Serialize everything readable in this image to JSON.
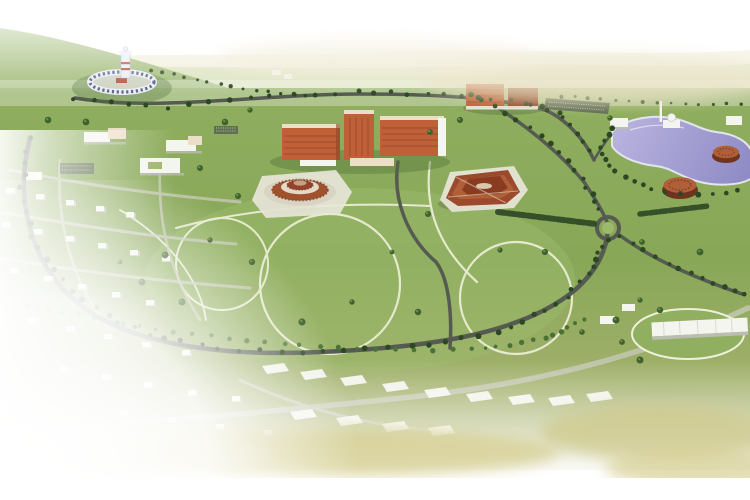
{
  "image": {
    "kind": "3d-aerial-masterplan-render",
    "width": 750,
    "height": 500
  },
  "colors": {
    "sky_white": "#ffffff",
    "haze_tan": "#e9e1c3",
    "haze_green": "#cfdcae",
    "hill_green": "#9cb873",
    "ground_top": "#8fae5f",
    "ground_mid": "#88a757",
    "ground_low": "#a4b16d",
    "ground_bottom": "#b8bd84",
    "ground_shadow": "#4f6f3a",
    "lawn_light": "#9cb96c",
    "road_dark": "#565b52",
    "road_light": "#c6c9b6",
    "path_cream": "#eef1da",
    "tree_dark": "#2c4723",
    "tree_mid": "#3f6130",
    "tree_light": "#67903f",
    "palm": "#4a7238",
    "lake_light": "#bab5e0",
    "lake_deep": "#8d89c4",
    "shore": "#e2e4ee",
    "white_bldg": "#f5f5f0",
    "bldg_shadow": "#b9bdb2",
    "red_bldg": "#c06038",
    "red_bldg_dark": "#8e4526",
    "roof_cream": "#ecdfc8",
    "rust": "#9c4a2e",
    "rust_light": "#b06038",
    "plaza": "#e9e7da",
    "tower_white": "#eceef4",
    "tower_band": "#b5543a",
    "parking_dark": "#5a6550",
    "khaki": "#d6cf92"
  },
  "scene": {
    "features": [
      "rolling-hills-horizon",
      "lighthouse-ring-complex",
      "central-academic-buildings",
      "northeast-red-buildings",
      "round-tiered-building-west",
      "round-tiered-building-east",
      "lake-with-mosque",
      "lakeside-drum-buildings",
      "campus-low-buildings",
      "residential-houses",
      "building-pads-row",
      "southeast-building",
      "roundabout",
      "tree-lined-roads",
      "lawn-footpaths",
      "faded-white-edges"
    ]
  }
}
